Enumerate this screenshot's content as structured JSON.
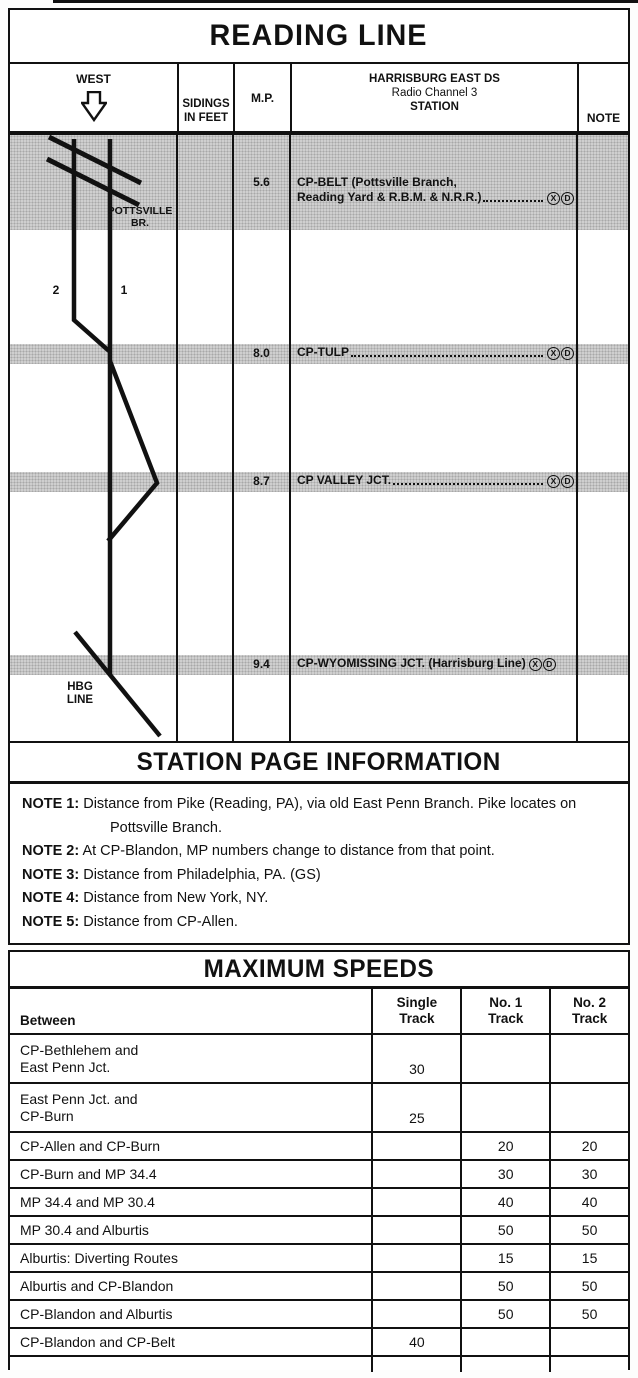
{
  "title": "READING LINE",
  "header": {
    "west": "WEST",
    "west_arrow_icon": "down-arrow-outline",
    "sidings": [
      "SIDINGS",
      "IN FEET"
    ],
    "mp": "M.P.",
    "station": [
      "HARRISBURG EAST DS",
      "Radio Channel 3",
      "STATION"
    ],
    "note": "NOTE"
  },
  "diagram": {
    "labels": {
      "pottsville_1": "POTTSVILLE",
      "pottsville_2": "BR.",
      "track2": "2",
      "track1": "1",
      "hbg_1": "HBG",
      "hbg_2": "LINE"
    },
    "stations": [
      {
        "mp": "5.6",
        "line1": "CP-BELT (Pottsville Branch,",
        "line2": "Reading Yard & R.B.M. & N.R.R.)",
        "sym1": "X",
        "sym2": "D"
      },
      {
        "mp": "8.0",
        "line1": "CP-TULP",
        "sym1": "X",
        "sym2": "D"
      },
      {
        "mp": "8.7",
        "line1": "CP VALLEY JCT.",
        "sym1": "X",
        "sym2": "D"
      },
      {
        "mp": "9.4",
        "line1": "CP-WYOMISSING JCT. (Harrisburg Line)",
        "sym1": "X",
        "sym2": "D"
      }
    ]
  },
  "spi": {
    "title": "STATION PAGE INFORMATION",
    "notes": [
      {
        "label": "NOTE 1:",
        "text": "Distance from Pike (Reading, PA), via old East Penn Branch. Pike locates on Pottsville Branch."
      },
      {
        "label": "NOTE 2:",
        "text": "At CP-Blandon, MP numbers change to distance from that point."
      },
      {
        "label": "NOTE 3:",
        "text": "Distance from Philadelphia, PA. (GS)"
      },
      {
        "label": "NOTE 4:",
        "text": "Distance from New York, NY."
      },
      {
        "label": "NOTE 5:",
        "text": "Distance from CP-Allen."
      }
    ]
  },
  "speeds": {
    "title": "MAXIMUM SPEEDS",
    "col_between": "Between",
    "col_single": [
      "Single",
      "Track"
    ],
    "col_no1": [
      "No. 1",
      "Track"
    ],
    "col_no2": [
      "No. 2",
      "Track"
    ],
    "rows": [
      {
        "between1": "CP-Bethlehem and",
        "between2": "East Penn Jct.",
        "single": "30",
        "no1": "",
        "no2": ""
      },
      {
        "between1": "East Penn Jct. and",
        "between2": "CP-Burn",
        "single": "25",
        "no1": "",
        "no2": ""
      },
      {
        "between1": "CP-Allen and CP-Burn",
        "between2": "",
        "single": "",
        "no1": "20",
        "no2": "20"
      },
      {
        "between1": "CP-Burn and MP 34.4",
        "between2": "",
        "single": "",
        "no1": "30",
        "no2": "30"
      },
      {
        "between1": "MP 34.4 and MP 30.4",
        "between2": "",
        "single": "",
        "no1": "40",
        "no2": "40"
      },
      {
        "between1": "MP 30.4 and Alburtis",
        "between2": "",
        "single": "",
        "no1": "50",
        "no2": "50"
      },
      {
        "between1": "Alburtis: Diverting Routes",
        "between2": "",
        "single": "",
        "no1": "15",
        "no2": "15"
      },
      {
        "between1": "Alburtis and CP-Blandon",
        "between2": "",
        "single": "",
        "no1": "50",
        "no2": "50"
      },
      {
        "between1": "CP-Blandon and Alburtis",
        "between2": "",
        "single": "",
        "no1": "50",
        "no2": "50"
      },
      {
        "between1": "CP-Blandon and CP-Belt",
        "between2": "",
        "single": "40",
        "no1": "",
        "no2": ""
      }
    ]
  }
}
